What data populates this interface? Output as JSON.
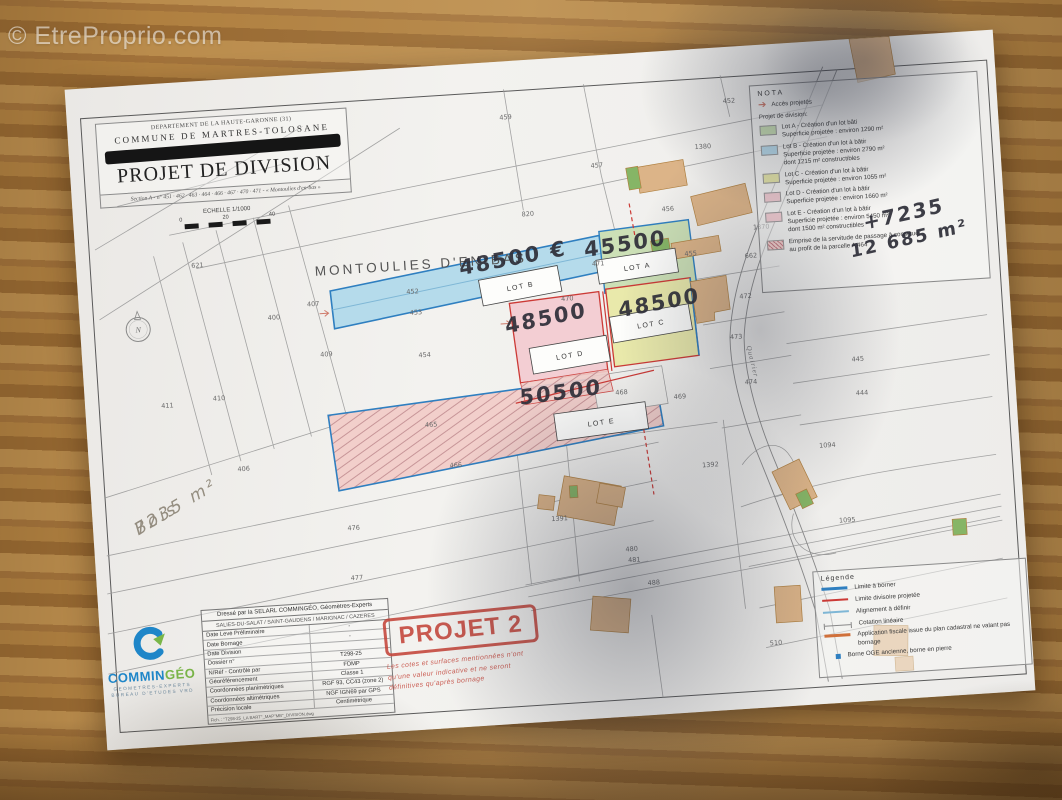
{
  "watermark": "© EtreProprio.com",
  "title_block": {
    "department": "DEPARTEMENT DE LA HAUTE-GARONNE (31)",
    "commune": "COMMUNE DE MARTRES-TOLOSANE",
    "title": "PROJET DE DIVISION",
    "section_line": "Section A - n° 451 · 462 · 463 · 464 · 466 · 467 · 470 · 471 - « Montoulies d'en-bas »",
    "scale_label": "ECHELLE 1/1000",
    "scale_ticks": [
      "0",
      "20",
      "40"
    ]
  },
  "map": {
    "place_label": "MONTOULIES D'EN-BAS",
    "north_label": "N",
    "road_label": "Quairier",
    "lot_colors": {
      "A": "#cce0b6",
      "B": "#b5dbeb",
      "C": "#e9e9ab",
      "D": "#f3ced3",
      "E": "#f2cfcb",
      "hatch_base": "#f2cfcb",
      "blue": "#2f7fc0",
      "red": "#cc3a36"
    },
    "lots": [
      {
        "id": "A",
        "label": "LOT A",
        "price": "45500"
      },
      {
        "id": "B",
        "label": "LOT B",
        "price": "48500 €"
      },
      {
        "id": "C",
        "label": "LOT C",
        "price": "48500"
      },
      {
        "id": "D",
        "label": "LOT D",
        "price": "48500"
      },
      {
        "id": "E",
        "label": "LOT E",
        "price": "50500"
      }
    ],
    "handwritten": {
      "bois_line1": "Bois",
      "bois_line2": "7235 m²",
      "plus": "+7235",
      "total": "12 685 m²"
    },
    "parcel_numbers": [
      {
        "n": "621",
        "x": 115,
        "y": 186
      },
      {
        "n": "407",
        "x": 228,
        "y": 232
      },
      {
        "n": "400",
        "x": 188,
        "y": 243
      },
      {
        "n": "409",
        "x": 238,
        "y": 283
      },
      {
        "n": "410",
        "x": 128,
        "y": 320
      },
      {
        "n": "411",
        "x": 76,
        "y": 324
      },
      {
        "n": "406",
        "x": 148,
        "y": 392
      },
      {
        "n": "459",
        "x": 432,
        "y": 58
      },
      {
        "n": "457",
        "x": 520,
        "y": 112
      },
      {
        "n": "820",
        "x": 448,
        "y": 156
      },
      {
        "n": "456",
        "x": 588,
        "y": 160
      },
      {
        "n": "1380",
        "x": 625,
        "y": 100
      },
      {
        "n": "452",
        "x": 656,
        "y": 56
      },
      {
        "n": "452",
        "x": 328,
        "y": 226
      },
      {
        "n": "453",
        "x": 330,
        "y": 247
      },
      {
        "n": "454",
        "x": 336,
        "y": 290
      },
      {
        "n": "471",
        "x": 515,
        "y": 210
      },
      {
        "n": "470",
        "x": 482,
        "y": 243
      },
      {
        "n": "455",
        "x": 608,
        "y": 206
      },
      {
        "n": "662",
        "x": 668,
        "y": 212
      },
      {
        "n": "1370",
        "x": 678,
        "y": 184
      },
      {
        "n": "472",
        "x": 660,
        "y": 252
      },
      {
        "n": "473",
        "x": 648,
        "y": 292
      },
      {
        "n": "474",
        "x": 660,
        "y": 338
      },
      {
        "n": "445",
        "x": 768,
        "y": 322
      },
      {
        "n": "444",
        "x": 770,
        "y": 356
      },
      {
        "n": "469",
        "x": 588,
        "y": 348
      },
      {
        "n": "468",
        "x": 530,
        "y": 340
      },
      {
        "n": "465",
        "x": 338,
        "y": 360
      },
      {
        "n": "466",
        "x": 360,
        "y": 402
      },
      {
        "n": "476",
        "x": 254,
        "y": 458
      },
      {
        "n": "477",
        "x": 254,
        "y": 508
      },
      {
        "n": "1391",
        "x": 458,
        "y": 462
      },
      {
        "n": "1392",
        "x": 612,
        "y": 418
      },
      {
        "n": "1094",
        "x": 730,
        "y": 406
      },
      {
        "n": "1095",
        "x": 745,
        "y": 482
      },
      {
        "n": "480",
        "x": 530,
        "y": 497
      },
      {
        "n": "481",
        "x": 532,
        "y": 508
      },
      {
        "n": "488",
        "x": 550,
        "y": 532
      },
      {
        "n": "510",
        "x": 668,
        "y": 600
      }
    ]
  },
  "nota": {
    "title": "NOTA",
    "acces": "Accès projetés",
    "subtitle": "Projet de division:",
    "items": [
      {
        "color": "#c8dfb4",
        "line1": "Lot A - Création d'un lot bâti",
        "line2": "Superficie projetée : environ 1290 m²",
        "line3": ""
      },
      {
        "color": "#b9dcec",
        "line1": "Lot B - Création d'un lot à bâtir",
        "line2": "Superficie projetée : environ 2790 m²",
        "line3": "dont 1215 m² constructibles"
      },
      {
        "color": "#e8e8aa",
        "line1": "Lot C - Création d'un lot à bâtir",
        "line2": "Superficie projetée : environ 1055 m²",
        "line3": ""
      },
      {
        "color": "#f2cdd2",
        "line1": "Lot D - Création d'un lot à bâtir",
        "line2": "Superficie projetée : environ 1660 m²",
        "line3": ""
      },
      {
        "color": "#f2cdd2",
        "line1": "Lot E - Création d'un lot à bâtir",
        "line2": "Superficie projetée : environ 5450 m²",
        "line3": "dont 1500 m² constructibles"
      },
      {
        "color": "#f2cfcb",
        "line1": "Emprise de la servitude de passage à constituer",
        "line2": "au profit de la parcelle A 464",
        "line3": ""
      }
    ]
  },
  "legend": {
    "title": "Légende",
    "items": [
      {
        "text": "Limite à borner"
      },
      {
        "text": "Limite divisoire projetée"
      },
      {
        "text": "Alignement à définir"
      },
      {
        "text": "Cotation linéaire"
      },
      {
        "text": "Application fiscale issue du plan cadastral ne valant pas bornage"
      },
      {
        "text": "Borne OGE ancienne, borne en pierre"
      }
    ]
  },
  "firm": {
    "logo_main": "COMMIN",
    "logo_geo": "GÉO",
    "logo_sub1": "GEOMETRES-EXPERTS",
    "logo_sub2": "BUREAU D'ETUDES VRD",
    "header1": "Dressé par la SELARL COMMINGÉO, Géomètres-Experts",
    "header2": "SALIES-DU-SALAT / SAINT-GAUDENS / MARIGNAC / CAZERES",
    "rows": [
      {
        "label": "Date Levé Préliminaire",
        "value": "-"
      },
      {
        "label": "Date Bornage",
        "value": "-"
      },
      {
        "label": "Date Division",
        "value": ""
      },
      {
        "label": "Dossier n°",
        "value": "T298-25"
      },
      {
        "label": "N/Réf - Contrôlé par",
        "value": "FDMP"
      },
      {
        "label": "Géoréférencement",
        "value": "Classe 1"
      },
      {
        "label": "Coordonnées planimétriques",
        "value": "RGF 93, CC43 (zone 2)"
      },
      {
        "label": "Coordonnées altimétriques",
        "value": "NGF IGN69 par GPS"
      },
      {
        "label": "Précision locale",
        "value": "Centimétrique"
      }
    ],
    "footer": "Fich. : \"T298-25_LA BART\"_MAP\"MB\"_DIVISION.dwg"
  },
  "stamp": {
    "title": "PROJET 2",
    "note": "Les cotes et surfaces mentionnées n'ont qu'une valeur indicative et ne seront définitives qu'après bornage"
  }
}
